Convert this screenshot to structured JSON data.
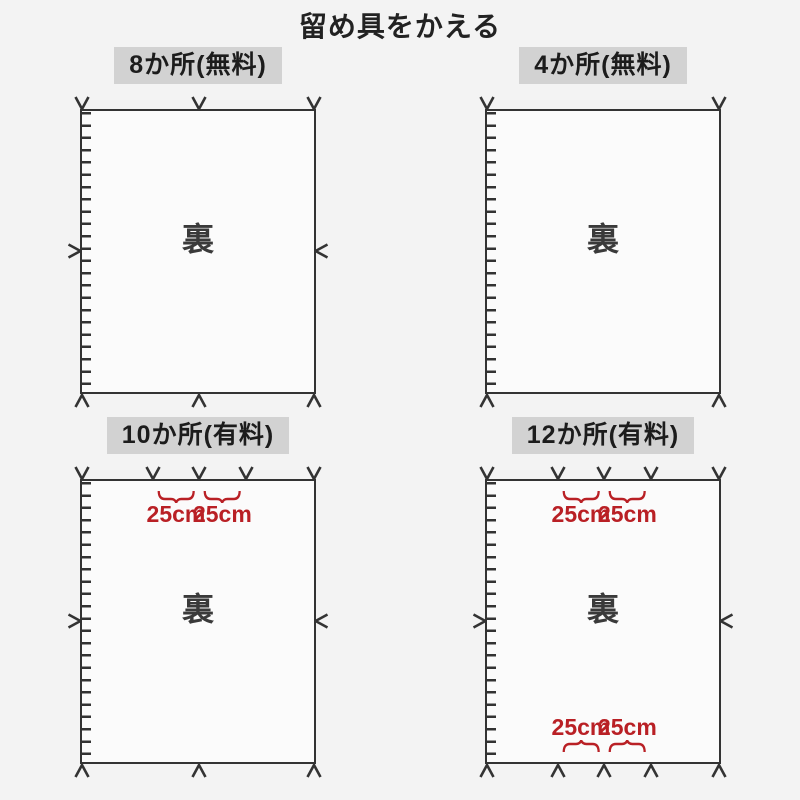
{
  "page": {
    "title": "留め具をかえる"
  },
  "colors": {
    "line": "#333333",
    "red": "#b92025",
    "header_bg": "#d2d2d2",
    "sheet_bg": "#fbfbfb",
    "page_bg": "#f3f3f3"
  },
  "panels": [
    {
      "title": "8か所(無料)",
      "back_label": "裏",
      "fasteners": {
        "top": [
          0,
          50.5,
          100
        ],
        "bottom": [
          0,
          50.5,
          100
        ],
        "left": [
          50
        ],
        "right": [
          50
        ]
      },
      "annotations": {
        "top": [],
        "bottom": []
      }
    },
    {
      "title": "4か所(無料)",
      "back_label": "裏",
      "fasteners": {
        "top": [
          0,
          100
        ],
        "bottom": [
          0,
          100
        ],
        "left": [],
        "right": []
      },
      "annotations": {
        "top": [],
        "bottom": []
      }
    },
    {
      "title": "10か所(有料)",
      "back_label": "裏",
      "fasteners": {
        "top": [
          0,
          30.5,
          50.5,
          70.5,
          100
        ],
        "bottom": [
          0,
          50.5,
          100
        ],
        "left": [
          50
        ],
        "right": [
          50
        ]
      },
      "annotations": {
        "top": [
          {
            "from": 30.5,
            "to": 50.5,
            "label": "25cm"
          },
          {
            "from": 50.5,
            "to": 70.5,
            "label": "25cm"
          }
        ],
        "bottom": []
      }
    },
    {
      "title": "12か所(有料)",
      "back_label": "裏",
      "fasteners": {
        "top": [
          0,
          30.5,
          50.5,
          70.5,
          100
        ],
        "bottom": [
          0,
          30.5,
          50.5,
          70.5,
          100
        ],
        "left": [
          50
        ],
        "right": [
          50
        ]
      },
      "annotations": {
        "top": [
          {
            "from": 30.5,
            "to": 50.5,
            "label": "25cm"
          },
          {
            "from": 50.5,
            "to": 70.5,
            "label": "25cm"
          }
        ],
        "bottom": [
          {
            "from": 30.5,
            "to": 50.5,
            "label": "25cm"
          },
          {
            "from": 50.5,
            "to": 70.5,
            "label": "25cm"
          }
        ]
      }
    }
  ]
}
